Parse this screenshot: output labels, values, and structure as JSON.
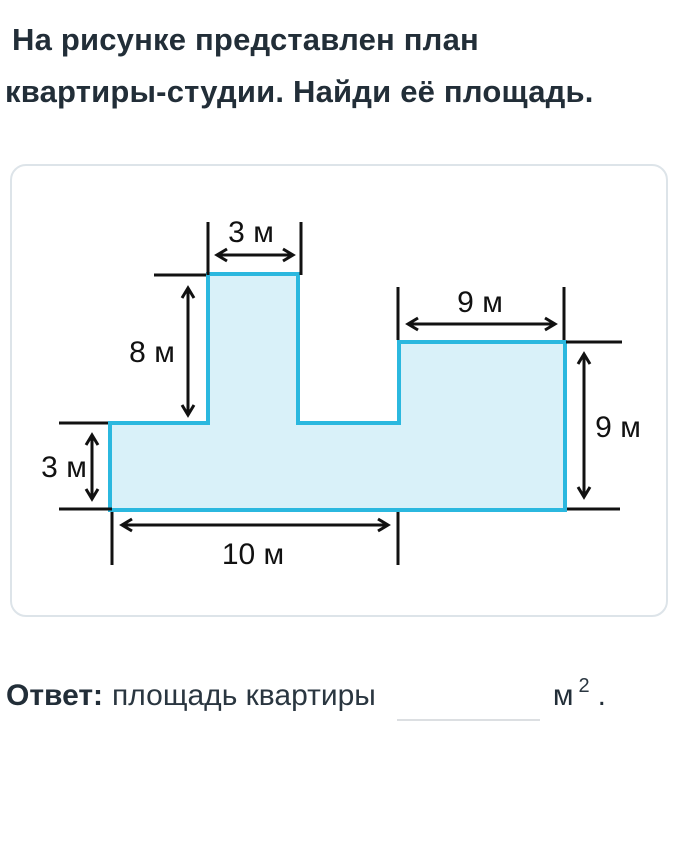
{
  "title": {
    "line1": "На рисунке представлен план",
    "line2": "квартиры-студии. Найди её площадь."
  },
  "diagram": {
    "labels": {
      "tower_width": "3 м",
      "tower_height": "8 м",
      "block_width": "9 м",
      "block_height": "9 м",
      "strip_height": "3 м",
      "bottom_width": "10 м"
    },
    "colors": {
      "shape_fill": "#d9f1f9",
      "shape_stroke": "#2bb8df",
      "annotation": "#111111"
    }
  },
  "answer": {
    "label": "Ответ:",
    "prompt": "площадь квартиры",
    "value": "",
    "unit": "м",
    "exponent": "2",
    "suffix": "."
  }
}
